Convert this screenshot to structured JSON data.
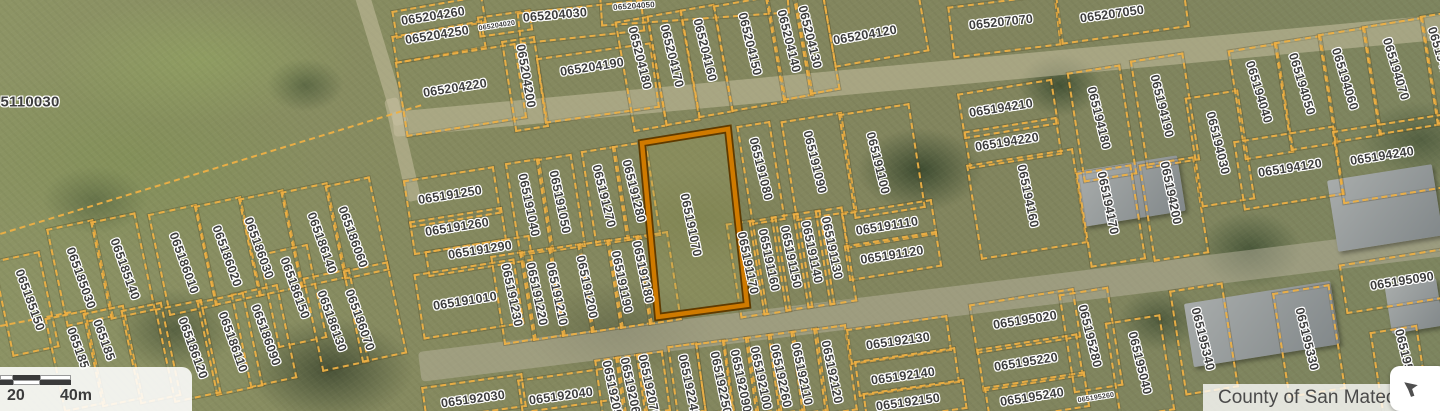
{
  "map": {
    "highlighted_parcel": "065191070",
    "highlight_polygon": "642,143 728,129 747,305 658,317",
    "colors": {
      "parcel_line": "#eeb044",
      "highlight_stroke": "#cf7a00",
      "highlight_outline": "#5e3a00",
      "label_text": "#3d3d3d",
      "attribution_text": "#4a4a4a"
    },
    "labels": [
      {
        "t": "5110030",
        "x": 30,
        "y": 102,
        "r": 0,
        "fs": 15
      },
      {
        "t": "065204260",
        "x": 433,
        "y": 16,
        "r": -9
      },
      {
        "t": "065204250",
        "x": 437,
        "y": 35,
        "r": -9
      },
      {
        "t": "065204020",
        "x": 497,
        "y": 26,
        "r": -9,
        "fs": 7
      },
      {
        "t": "065204030",
        "x": 555,
        "y": 15,
        "r": -5
      },
      {
        "t": "065204050",
        "x": 634,
        "y": 6,
        "r": -4,
        "fs": 8
      },
      {
        "t": "065204220",
        "x": 455,
        "y": 88,
        "r": -9
      },
      {
        "t": "065204200",
        "x": 526,
        "y": 76,
        "r": 80
      },
      {
        "t": "065204190",
        "x": 592,
        "y": 67,
        "r": -9
      },
      {
        "t": "065204180",
        "x": 640,
        "y": 58,
        "r": 76
      },
      {
        "t": "065204170",
        "x": 672,
        "y": 56,
        "r": 76
      },
      {
        "t": "065204160",
        "x": 705,
        "y": 50,
        "r": 76
      },
      {
        "t": "065204150",
        "x": 750,
        "y": 44,
        "r": 76
      },
      {
        "t": "065204140",
        "x": 789,
        "y": 41,
        "r": 76
      },
      {
        "t": "065204130",
        "x": 810,
        "y": 37,
        "r": 76
      },
      {
        "t": "065204120",
        "x": 865,
        "y": 35,
        "r": -10
      },
      {
        "t": "065207070",
        "x": 1001,
        "y": 22,
        "r": -6
      },
      {
        "t": "065207050",
        "x": 1112,
        "y": 14,
        "r": -8
      },
      {
        "t": "065194210",
        "x": 1001,
        "y": 108,
        "r": -9
      },
      {
        "t": "065194220",
        "x": 1007,
        "y": 142,
        "r": -9
      },
      {
        "t": "065194160",
        "x": 1028,
        "y": 196,
        "r": 78
      },
      {
        "t": "065194180",
        "x": 1099,
        "y": 118,
        "r": 76
      },
      {
        "t": "065194190",
        "x": 1162,
        "y": 106,
        "r": 76
      },
      {
        "t": "065194170",
        "x": 1108,
        "y": 203,
        "r": 78
      },
      {
        "t": "065194200",
        "x": 1171,
        "y": 193,
        "r": 78
      },
      {
        "t": "065194030",
        "x": 1218,
        "y": 143,
        "r": 76
      },
      {
        "t": "065194040",
        "x": 1259,
        "y": 92,
        "r": 73
      },
      {
        "t": "065194050",
        "x": 1302,
        "y": 84,
        "r": 73
      },
      {
        "t": "065194060",
        "x": 1345,
        "y": 79,
        "r": 73
      },
      {
        "t": "065194070",
        "x": 1396,
        "y": 69,
        "r": 73
      },
      {
        "t": "065194080",
        "x": 1441,
        "y": 58,
        "r": 73
      },
      {
        "t": "065194120",
        "x": 1290,
        "y": 168,
        "r": -9
      },
      {
        "t": "065194240",
        "x": 1382,
        "y": 156,
        "r": -9
      },
      {
        "t": "065191250",
        "x": 450,
        "y": 195,
        "r": -9
      },
      {
        "t": "065191260",
        "x": 457,
        "y": 227,
        "r": -9
      },
      {
        "t": "065191290",
        "x": 480,
        "y": 250,
        "r": -9
      },
      {
        "t": "065191010",
        "x": 465,
        "y": 301,
        "r": -9
      },
      {
        "t": "065191040",
        "x": 529,
        "y": 205,
        "r": 78
      },
      {
        "t": "065191050",
        "x": 560,
        "y": 202,
        "r": 78
      },
      {
        "t": "065191270",
        "x": 604,
        "y": 196,
        "r": 76
      },
      {
        "t": "065191280",
        "x": 634,
        "y": 191,
        "r": 76
      },
      {
        "t": "065191230",
        "x": 512,
        "y": 295,
        "r": 78
      },
      {
        "t": "065191220",
        "x": 537,
        "y": 294,
        "r": 78
      },
      {
        "t": "065191210",
        "x": 557,
        "y": 294,
        "r": 78
      },
      {
        "t": "065191200",
        "x": 587,
        "y": 287,
        "r": 78
      },
      {
        "t": "065191190",
        "x": 622,
        "y": 282,
        "r": 78
      },
      {
        "t": "065191180",
        "x": 643,
        "y": 272,
        "r": 78
      },
      {
        "t": "065191070",
        "x": 691,
        "y": 225,
        "r": 78
      },
      {
        "t": "065191080",
        "x": 761,
        "y": 169,
        "r": 76
      },
      {
        "t": "065191090",
        "x": 815,
        "y": 162,
        "r": 76
      },
      {
        "t": "065191100",
        "x": 878,
        "y": 163,
        "r": 76
      },
      {
        "t": "065191110",
        "x": 887,
        "y": 226,
        "r": -9
      },
      {
        "t": "065191120",
        "x": 892,
        "y": 255,
        "r": -9
      },
      {
        "t": "065191130",
        "x": 832,
        "y": 248,
        "r": 78
      },
      {
        "t": "065191140",
        "x": 812,
        "y": 252,
        "r": 78
      },
      {
        "t": "065191150",
        "x": 791,
        "y": 257,
        "r": 78
      },
      {
        "t": "065191160",
        "x": 769,
        "y": 260,
        "r": 78
      },
      {
        "t": "065191170",
        "x": 748,
        "y": 263,
        "r": 78
      },
      {
        "t": "065185030",
        "x": 81,
        "y": 278,
        "r": 70
      },
      {
        "t": "065185140",
        "x": 125,
        "y": 269,
        "r": 70
      },
      {
        "t": "065185150",
        "x": 30,
        "y": 300,
        "r": 70
      },
      {
        "t": "065186010",
        "x": 184,
        "y": 263,
        "r": 70
      },
      {
        "t": "065186020",
        "x": 227,
        "y": 256,
        "r": 70
      },
      {
        "t": "065186030",
        "x": 259,
        "y": 248,
        "r": 70
      },
      {
        "t": "065186140",
        "x": 322,
        "y": 243,
        "r": 70
      },
      {
        "t": "065186060",
        "x": 353,
        "y": 237,
        "r": 70
      },
      {
        "t": "065186150",
        "x": 295,
        "y": 288,
        "r": 70
      },
      {
        "t": "065186130",
        "x": 332,
        "y": 321,
        "r": 70
      },
      {
        "t": "065186070",
        "x": 360,
        "y": 320,
        "r": 70
      },
      {
        "t": "065186090",
        "x": 266,
        "y": 335,
        "r": 70
      },
      {
        "t": "065186110",
        "x": 233,
        "y": 342,
        "r": 70
      },
      {
        "t": "065186120",
        "x": 193,
        "y": 348,
        "r": 70
      },
      {
        "t": "065185",
        "x": 78,
        "y": 348,
        "r": 70
      },
      {
        "t": "065185",
        "x": 104,
        "y": 340,
        "r": 70
      },
      {
        "t": "065192030",
        "x": 473,
        "y": 399,
        "r": -8
      },
      {
        "t": "065192040",
        "x": 561,
        "y": 396,
        "r": -8
      },
      {
        "t": "065192050",
        "x": 613,
        "y": 392,
        "r": 78
      },
      {
        "t": "065192060",
        "x": 631,
        "y": 389,
        "r": 78
      },
      {
        "t": "065192070",
        "x": 649,
        "y": 386,
        "r": 78
      },
      {
        "t": "065192240",
        "x": 689,
        "y": 386,
        "r": 78
      },
      {
        "t": "065192250",
        "x": 721,
        "y": 383,
        "r": 78
      },
      {
        "t": "065192090",
        "x": 741,
        "y": 381,
        "r": 78
      },
      {
        "t": "065192100",
        "x": 761,
        "y": 378,
        "r": 78
      },
      {
        "t": "065192260",
        "x": 781,
        "y": 376,
        "r": 78
      },
      {
        "t": "065192110",
        "x": 802,
        "y": 374,
        "r": 78
      },
      {
        "t": "065192120",
        "x": 832,
        "y": 372,
        "r": 78
      },
      {
        "t": "065192130",
        "x": 898,
        "y": 341,
        "r": -8
      },
      {
        "t": "065192140",
        "x": 903,
        "y": 376,
        "r": -8
      },
      {
        "t": "065192150",
        "x": 908,
        "y": 402,
        "r": -8
      },
      {
        "t": "065195020",
        "x": 1025,
        "y": 320,
        "r": -9
      },
      {
        "t": "065195220",
        "x": 1026,
        "y": 362,
        "r": -9
      },
      {
        "t": "065195240",
        "x": 1032,
        "y": 397,
        "r": -9
      },
      {
        "t": "065195260",
        "x": 1096,
        "y": 398,
        "r": -9,
        "fs": 7
      },
      {
        "t": "065195280",
        "x": 1090,
        "y": 336,
        "r": 76
      },
      {
        "t": "065195040",
        "x": 1140,
        "y": 363,
        "r": 76
      },
      {
        "t": "065195340",
        "x": 1203,
        "y": 339,
        "r": 76
      },
      {
        "t": "065195330",
        "x": 1307,
        "y": 339,
        "r": 76
      },
      {
        "t": "065195090",
        "x": 1402,
        "y": 281,
        "r": -9
      },
      {
        "t": "065195",
        "x": 1404,
        "y": 350,
        "r": 76
      }
    ],
    "parcels": [
      [
        393,
        3,
        88,
        24,
        -10
      ],
      [
        393,
        28,
        88,
        24,
        -10
      ],
      [
        478,
        13,
        50,
        17,
        -8
      ],
      [
        518,
        6,
        122,
        28,
        -6
      ],
      [
        600,
        -10,
        185,
        26,
        -4
      ],
      [
        400,
        52,
        118,
        72,
        -9
      ],
      [
        508,
        38,
        30,
        88,
        -9
      ],
      [
        540,
        50,
        112,
        62,
        -8
      ],
      [
        624,
        18,
        30,
        108,
        -10
      ],
      [
        656,
        12,
        31,
        108,
        -10
      ],
      [
        689,
        6,
        31,
        106,
        -10
      ],
      [
        722,
        0,
        52,
        104,
        -10
      ],
      [
        774,
        -5,
        27,
        100,
        -10
      ],
      [
        801,
        -9,
        27,
        98,
        -10
      ],
      [
        828,
        -12,
        92,
        68,
        -10
      ],
      [
        950,
        0,
        105,
        48,
        -7
      ],
      [
        1058,
        -12,
        125,
        44,
        -8
      ],
      [
        960,
        86,
        92,
        42,
        -9
      ],
      [
        966,
        124,
        90,
        34,
        -9
      ],
      [
        973,
        156,
        104,
        92,
        -9
      ],
      [
        1075,
        68,
        50,
        107,
        -9
      ],
      [
        1138,
        56,
        50,
        105,
        -9
      ],
      [
        1083,
        168,
        52,
        92,
        -9
      ],
      [
        1146,
        160,
        52,
        94,
        -9
      ],
      [
        1193,
        93,
        50,
        107,
        -9
      ],
      [
        1236,
        46,
        46,
        107,
        -9
      ],
      [
        1282,
        38,
        44,
        106,
        -9
      ],
      [
        1326,
        30,
        44,
        106,
        -9
      ],
      [
        1370,
        21,
        58,
        106,
        -9
      ],
      [
        1428,
        12,
        40,
        106,
        -9
      ],
      [
        1238,
        133,
        98,
        66,
        -9
      ],
      [
        1337,
        122,
        108,
        70,
        -9
      ],
      [
        406,
        173,
        88,
        44,
        -9
      ],
      [
        411,
        214,
        90,
        30,
        -9
      ],
      [
        426,
        243,
        102,
        22,
        -9
      ],
      [
        418,
        266,
        98,
        62,
        -9
      ],
      [
        512,
        160,
        31,
        90,
        -9
      ],
      [
        543,
        156,
        32,
        90,
        -9
      ],
      [
        588,
        148,
        31,
        92,
        -9
      ],
      [
        619,
        143,
        31,
        92,
        -9
      ],
      [
        497,
        253,
        29,
        86,
        -9
      ],
      [
        526,
        249,
        29,
        86,
        -9
      ],
      [
        555,
        245,
        29,
        86,
        -9
      ],
      [
        584,
        241,
        29,
        86,
        -9
      ],
      [
        613,
        237,
        29,
        86,
        -9
      ],
      [
        642,
        233,
        29,
        86,
        -9
      ],
      [
        744,
        123,
        30,
        96,
        -9
      ],
      [
        788,
        116,
        58,
        97,
        -9
      ],
      [
        846,
        108,
        68,
        102,
        -9
      ],
      [
        843,
        206,
        88,
        32,
        -9
      ],
      [
        846,
        238,
        90,
        32,
        -9
      ],
      [
        733,
        221,
        24,
        92,
        -9
      ],
      [
        756,
        218,
        24,
        92,
        -9
      ],
      [
        778,
        214,
        24,
        92,
        -9
      ],
      [
        800,
        211,
        24,
        92,
        -9
      ],
      [
        822,
        208,
        24,
        92,
        -9
      ],
      [
        56,
        223,
        44,
        96,
        -12
      ],
      [
        100,
        216,
        42,
        96,
        -12
      ],
      [
        2,
        255,
        44,
        94,
        -12
      ],
      [
        158,
        208,
        46,
        100,
        -12
      ],
      [
        204,
        200,
        44,
        98,
        -12
      ],
      [
        248,
        193,
        42,
        96,
        -12
      ],
      [
        290,
        186,
        44,
        94,
        -12
      ],
      [
        334,
        180,
        42,
        92,
        -12
      ],
      [
        268,
        248,
        46,
        92,
        -12
      ],
      [
        312,
        272,
        44,
        92,
        -12
      ],
      [
        352,
        265,
        42,
        90,
        -12
      ],
      [
        240,
        288,
        44,
        92,
        -12
      ],
      [
        206,
        296,
        44,
        92,
        -12
      ],
      [
        164,
        303,
        44,
        92,
        -12
      ],
      [
        54,
        313,
        38,
        92,
        -12
      ],
      [
        92,
        308,
        38,
        92,
        -12
      ],
      [
        130,
        305,
        38,
        92,
        -12
      ],
      [
        423,
        380,
        98,
        30,
        -8
      ],
      [
        519,
        373,
        92,
        30,
        -8
      ],
      [
        598,
        358,
        21,
        53,
        -8
      ],
      [
        619,
        355,
        21,
        55,
        -8
      ],
      [
        640,
        352,
        23,
        57,
        -8
      ],
      [
        672,
        344,
        26,
        66,
        -8
      ],
      [
        700,
        341,
        26,
        68,
        -8
      ],
      [
        727,
        338,
        23,
        72,
        -8
      ],
      [
        750,
        335,
        23,
        74,
        -8
      ],
      [
        773,
        332,
        23,
        77,
        -8
      ],
      [
        796,
        329,
        23,
        80,
        -8
      ],
      [
        819,
        326,
        29,
        83,
        -8
      ],
      [
        848,
        322,
        98,
        32,
        -8
      ],
      [
        856,
        354,
        98,
        32,
        -8
      ],
      [
        864,
        386,
        98,
        26,
        -8
      ],
      [
        972,
        296,
        102,
        46,
        -9
      ],
      [
        979,
        341,
        98,
        39,
        -9
      ],
      [
        986,
        379,
        98,
        32,
        -9
      ],
      [
        1066,
        290,
        46,
        96,
        -9
      ],
      [
        1112,
        318,
        52,
        93,
        -9
      ],
      [
        1177,
        286,
        50,
        102,
        -9
      ],
      [
        1280,
        288,
        54,
        102,
        -9
      ],
      [
        1342,
        256,
        104,
        46,
        -9
      ],
      [
        1376,
        328,
        44,
        83,
        -9
      ]
    ],
    "boundary_lines": [
      [
        0,
        233,
        440,
        -17
      ],
      [
        0,
        325,
        72,
        -11
      ]
    ]
  },
  "scalebar": {
    "label_20": "20",
    "label_40": "40m"
  },
  "attribution": {
    "text": "County of San Mateo"
  },
  "controls": {
    "arrow_button": "nw-arrow"
  }
}
